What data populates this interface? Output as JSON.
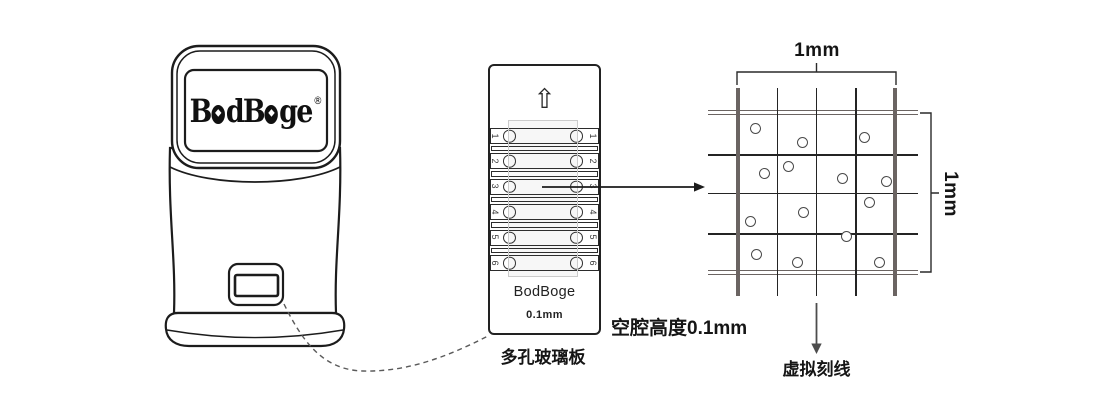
{
  "page": {
    "width": 1120,
    "height": 400,
    "background": "#ffffff"
  },
  "device": {
    "logo": {
      "text": "BodBoge®",
      "p1": "B",
      "p2": "dB",
      "p3": "ge",
      "o_inner": "◆",
      "reg": "®"
    }
  },
  "slide": {
    "up_arrow_icon": "⇧",
    "row_numbers": [
      "1",
      "2",
      "3",
      "4",
      "5",
      "6"
    ],
    "brand": "BodBoge",
    "cavity_spec": "0.1mm",
    "caption": "多孔玻璃板"
  },
  "labels": {
    "cavity_height": "空腔高度0.1mm",
    "width_dimension": "1mm",
    "height_dimension": "1mm",
    "virtual_gridlines": "虚拟刻线"
  },
  "grid": {
    "x_extent": [
      708,
      918
    ],
    "y_extent": [
      88,
      296
    ],
    "verticals": [
      {
        "x": 738,
        "thick": true
      },
      {
        "x": 777.3,
        "thick": false
      },
      {
        "x": 816.5,
        "thick": false
      },
      {
        "x": 855.8,
        "thick": false
      },
      {
        "x": 895,
        "thick": true
      }
    ],
    "horizontals": [
      {
        "y": 112.5,
        "thick": true
      },
      {
        "y": 154.8,
        "thick": false
      },
      {
        "y": 193.6,
        "thick": false
      },
      {
        "y": 234,
        "thick": false
      },
      {
        "y": 272.5,
        "thick": true
      }
    ],
    "cells": [
      [
        755,
        128
      ],
      [
        802,
        142
      ],
      [
        864,
        137
      ],
      [
        788,
        166
      ],
      [
        764,
        173
      ],
      [
        842,
        178
      ],
      [
        886,
        181
      ],
      [
        869,
        202
      ],
      [
        803,
        212
      ],
      [
        750,
        221
      ],
      [
        846,
        236
      ],
      [
        756,
        254
      ],
      [
        797,
        262
      ],
      [
        879,
        262
      ]
    ]
  },
  "colors": {
    "ink": "#1c1c1c",
    "thick_line": "#6b6462",
    "thin_line": "#242424",
    "dot_stroke": "#4a4a4a",
    "arrow_gray": "#4d4d4d",
    "dash_gray": "#5a5a5a"
  }
}
